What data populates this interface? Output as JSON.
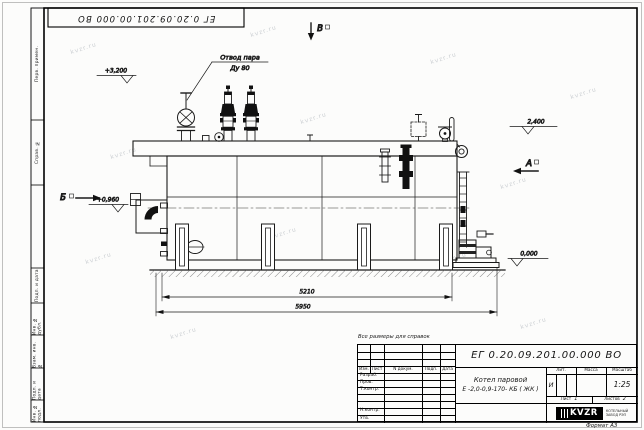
{
  "watermark": {
    "text": "kvzr.ru"
  },
  "stamp": {
    "doc_number_inverted": "ЕГ 0.20.09.201.00.000  ВО"
  },
  "margin_fields": {
    "perv": "Перв. примен.",
    "sprav": "Справ. №",
    "podp1": "Подп. и дата",
    "inv_dubl": "Инв. № дубл.",
    "vzam": "Взам. инв. №",
    "podp2": "Подп. и дата",
    "inv_podl": "Инв. № подл."
  },
  "drawing": {
    "callout_line1": "Отвод пара",
    "callout_line2": "Ду 80",
    "elev_top_left": "+3,200",
    "elev_right": "2,400",
    "elev_mid_left": "+0,960",
    "elev_ground": "0,000",
    "view_b": "Б",
    "view_v": "В",
    "view_a": "А",
    "dim_inner": "5210",
    "dim_outer": "5950"
  },
  "note": "Все размеры для справок",
  "title_block": {
    "doc_number": "ЕГ 0.20.09.201.00.000  ВО",
    "name_line1": "Котел паровой",
    "name_line2": "Е -2,0-0,9-170- КБ ( ЖК )",
    "col_izm": "Изм.",
    "col_list": "Лист",
    "col_ndoc": "N докум.",
    "col_podp": "Подп.",
    "col_data": "Дата",
    "row_razrab": "Разраб.",
    "row_prov": "Пров.",
    "row_tkontr": "Т.контр.",
    "row_nkontr": "Н.контр.",
    "row_utv": "Утв.",
    "lit_label": "Лит.",
    "mass_label": "Масса",
    "scale_label": "Масштаб",
    "lit_value": "И",
    "scale_value": "1:25",
    "sheet_label": "Лист",
    "sheet_value": "1",
    "sheets_label": "Листов",
    "sheets_value": "2",
    "logo_text": "KVZR",
    "logo_caption1": "КОТЕЛЬНЫЙ",
    "logo_caption2": "ЗАВОД РЭП",
    "format": "Формат А3"
  }
}
